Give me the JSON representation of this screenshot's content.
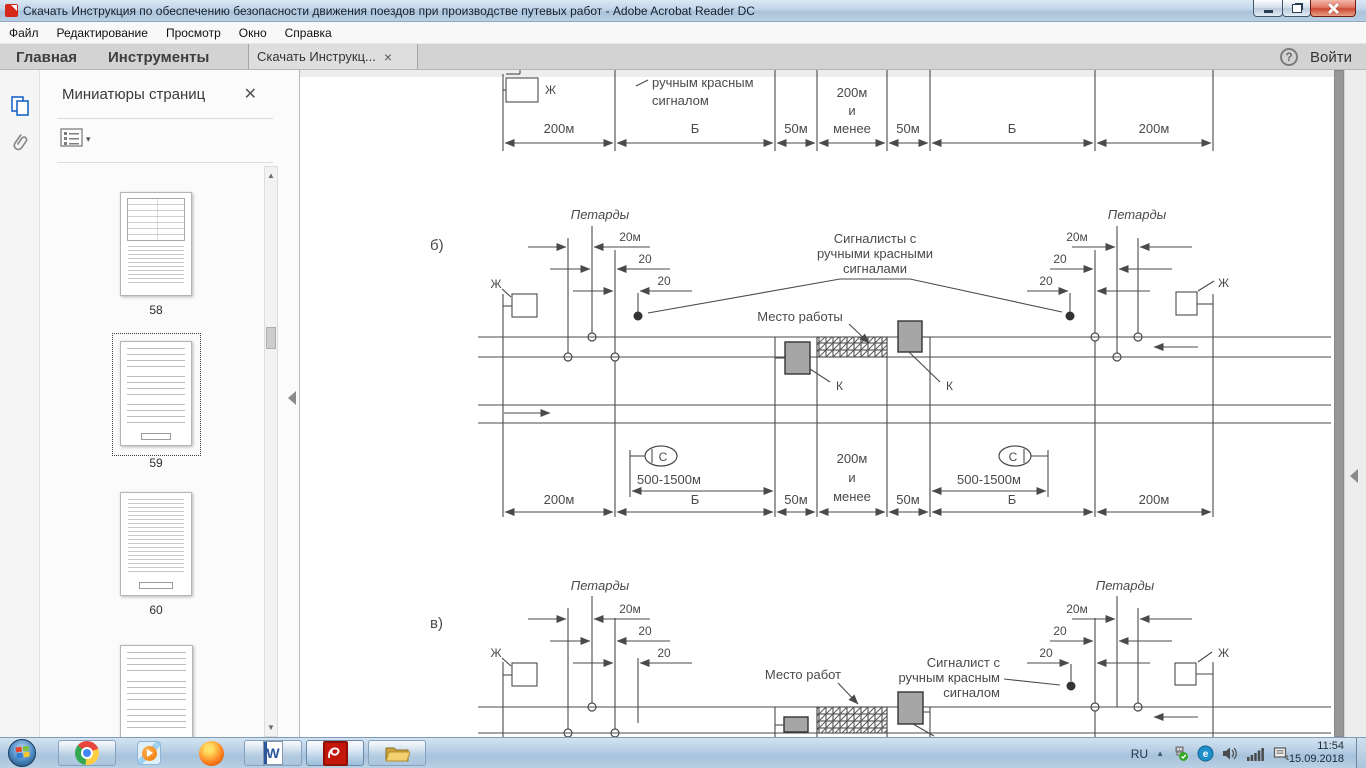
{
  "titlebar": {
    "title": "Скачать  Инструкция по обеспечению безопасности движения поездов при производстве путевых работ - Adobe Acrobat Reader DC"
  },
  "menubar": {
    "items": [
      "Файл",
      "Редактирование",
      "Просмотр",
      "Окно",
      "Справка"
    ]
  },
  "tabbar": {
    "home_tab": "Главная",
    "tools_tab": "Инструменты",
    "doc_tab": "Скачать  Инструкц...",
    "sign_in": "Войти"
  },
  "panel": {
    "title": "Миниатюры страниц",
    "page_numbers": [
      "58",
      "59",
      "60"
    ]
  },
  "diagram": {
    "label_b": "б)",
    "label_v": "в)",
    "petards": "Петарды",
    "dim_20m": "20м",
    "dim_20": "20",
    "zh": "Ж",
    "k": "К",
    "s": "С",
    "range": "500-1500м",
    "zone_200m": "200м",
    "zone_b": "Б",
    "zone_50m": "50м",
    "zone_and": "и",
    "zone_less": "менее",
    "signalers_line1": "Сигналисты с",
    "signalers_line2": "ручными красными",
    "signalers_line3": "сигналами",
    "signaler_line1": "Сигналист с",
    "signaler_line2": "ручным красным",
    "signaler_line3": "сигналом",
    "worksite_b": "Место работы",
    "worksite_v": "Место работ",
    "cut_line1": "ручным красным",
    "cut_line2": "сигналом"
  },
  "tray": {
    "lang": "RU",
    "time": "11:54",
    "date": "15.09.2018"
  },
  "icons": {
    "close_panel": "✕",
    "close_tab": "×",
    "caret_down": "▾",
    "scroll_up": "▲",
    "scroll_down": "▼",
    "help": "?",
    "word_letter": "W",
    "tray_app_letter": "e"
  }
}
